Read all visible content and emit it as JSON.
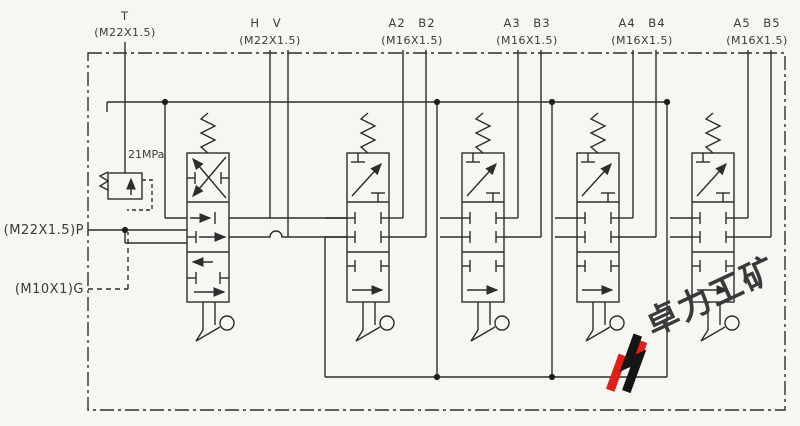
{
  "ports": {
    "t": {
      "name": "T",
      "thread": "(M22X1.5)"
    },
    "hv": {
      "name": "H V",
      "thread": "(M22X1.5)"
    },
    "a2b2": {
      "name": "A2 B2",
      "thread": "(M16X1.5)"
    },
    "a3b3": {
      "name": "A3 B3",
      "thread": "(M16X1.5)"
    },
    "a4b4": {
      "name": "A4 B4",
      "thread": "(M16X1.5)"
    },
    "a5b5": {
      "name": "A5 B5",
      "thread": "(M16X1.5)"
    },
    "p": {
      "label": "(M22X1.5)P"
    },
    "g": {
      "label": "(M10X1)G"
    }
  },
  "relief_valve": {
    "pressure": "21MPa"
  },
  "watermark": {
    "text": "卓力工矿",
    "red": "#df2018",
    "black": "#151515"
  },
  "style": {
    "line_color": "#2d2d2d",
    "background": "#f7f6f2"
  }
}
